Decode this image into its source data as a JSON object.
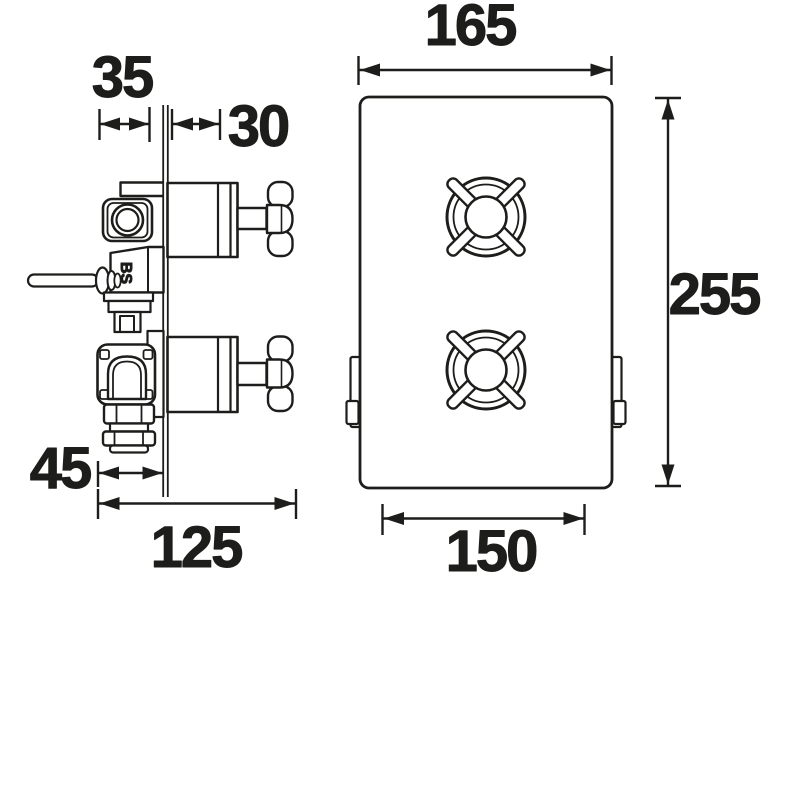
{
  "palette": {
    "ink": "#1d1d1b",
    "paper": "#ffffff"
  },
  "drawing": {
    "kind": "thermostatic-shower-valve-dimension-drawing",
    "side_view": {
      "stamp": "BS",
      "dim_plate_offset": "35",
      "dim_handle_projection": "30",
      "dim_inlet_depth": "45",
      "dim_overall_depth": "125"
    },
    "front_view": {
      "dim_overall_width": "165",
      "dim_overall_height": "255",
      "dim_plate_bottom_width": "150"
    }
  }
}
